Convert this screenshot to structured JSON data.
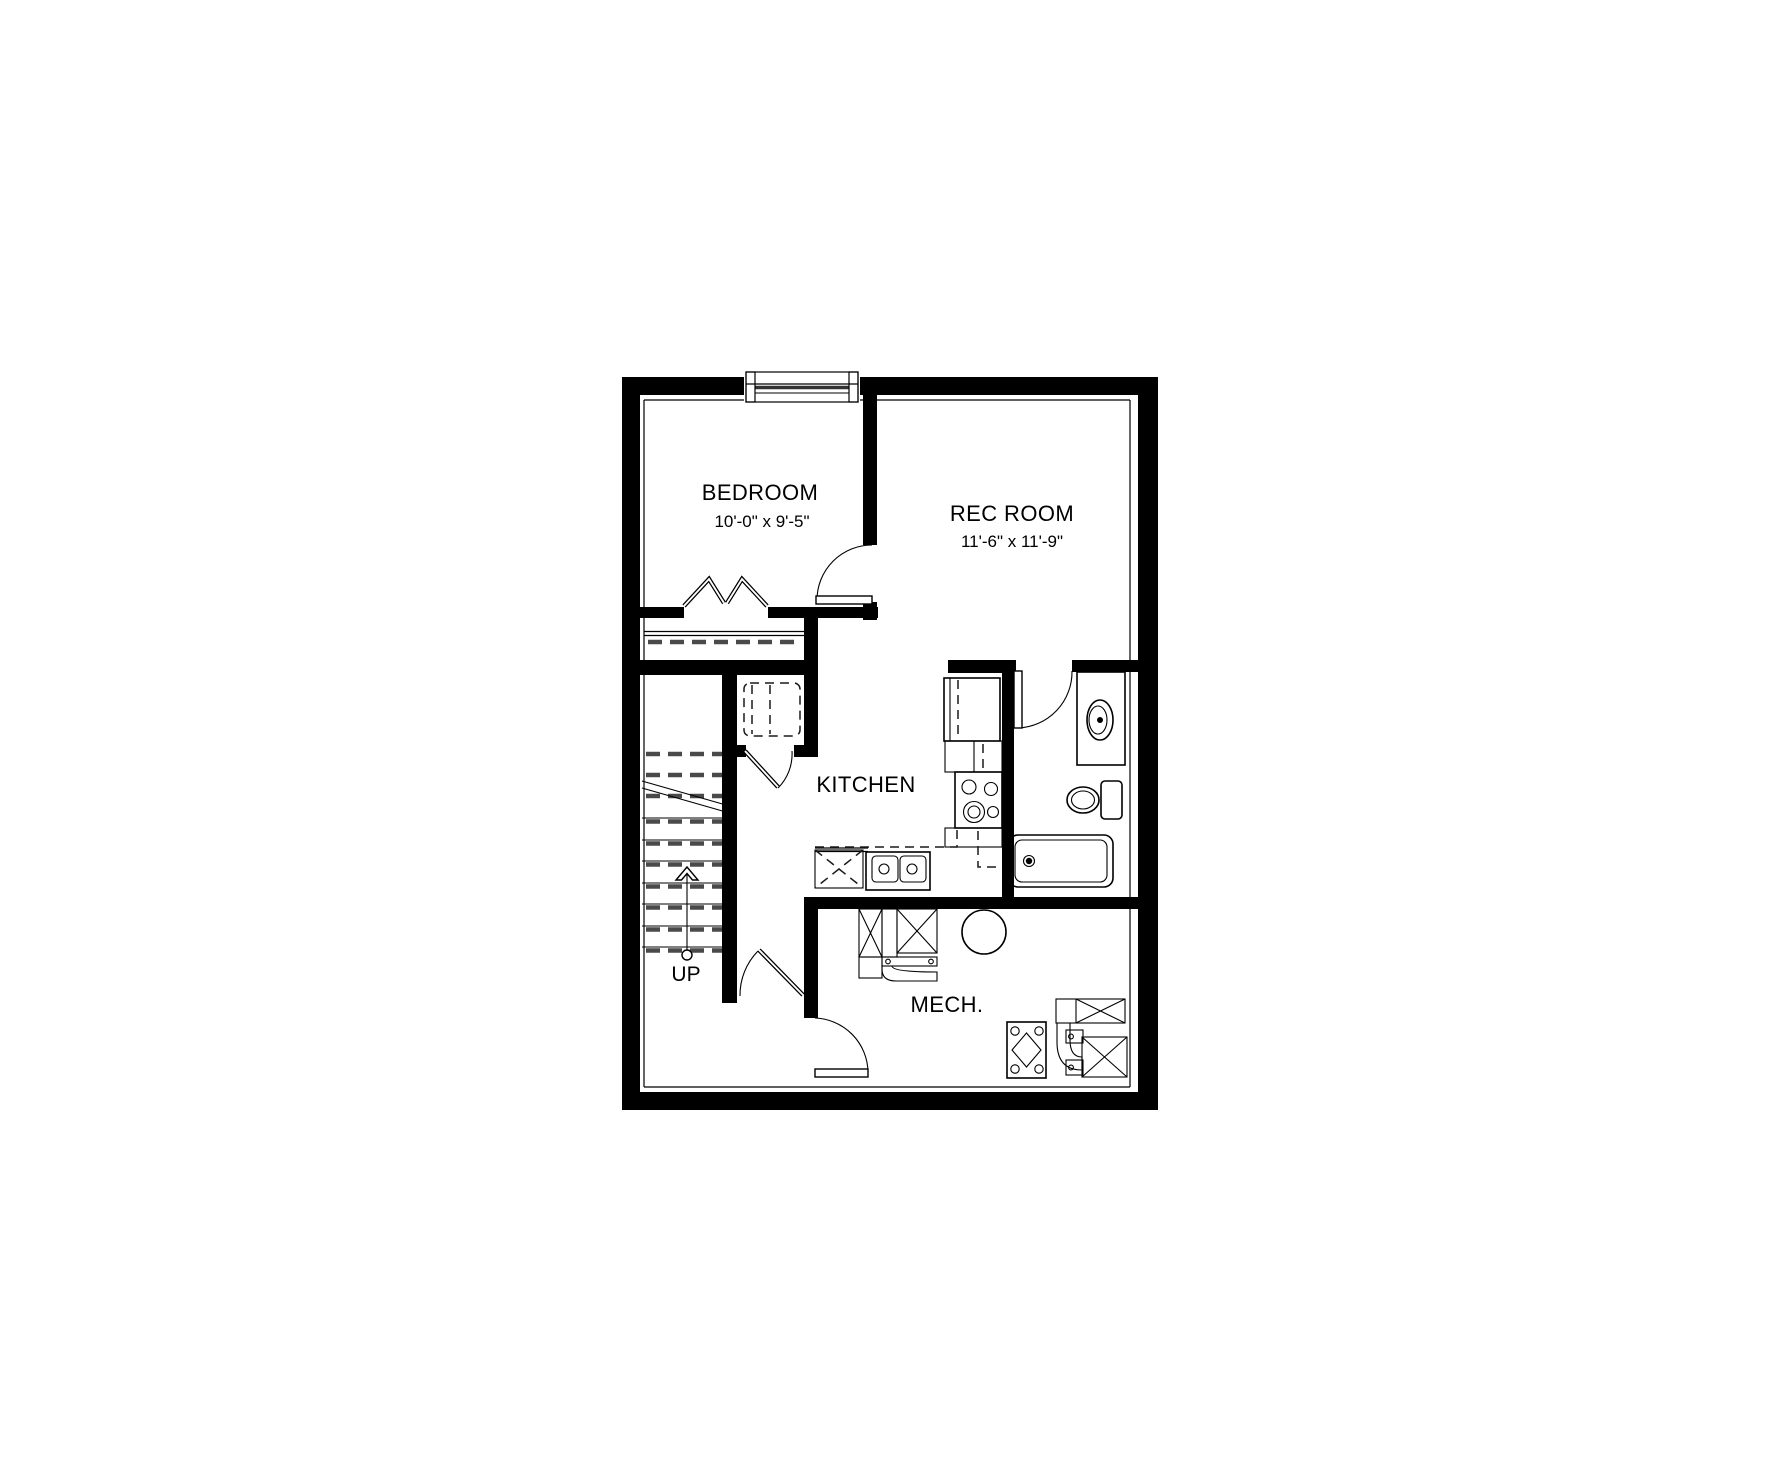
{
  "plan": {
    "background_color": "#ffffff",
    "wall_color": "#000000",
    "overhead_dash_color": "#4a4a4a",
    "rooms": {
      "bedroom": {
        "name": "BEDROOM",
        "dims": "10'-0\" x 9'-5\""
      },
      "rec_room": {
        "name": "REC ROOM",
        "dims": "11'-6\" x 11'-9\""
      },
      "kitchen": {
        "name": "KITCHEN"
      },
      "mech": {
        "name": "MECH."
      }
    },
    "stairs": {
      "label": "UP"
    }
  }
}
